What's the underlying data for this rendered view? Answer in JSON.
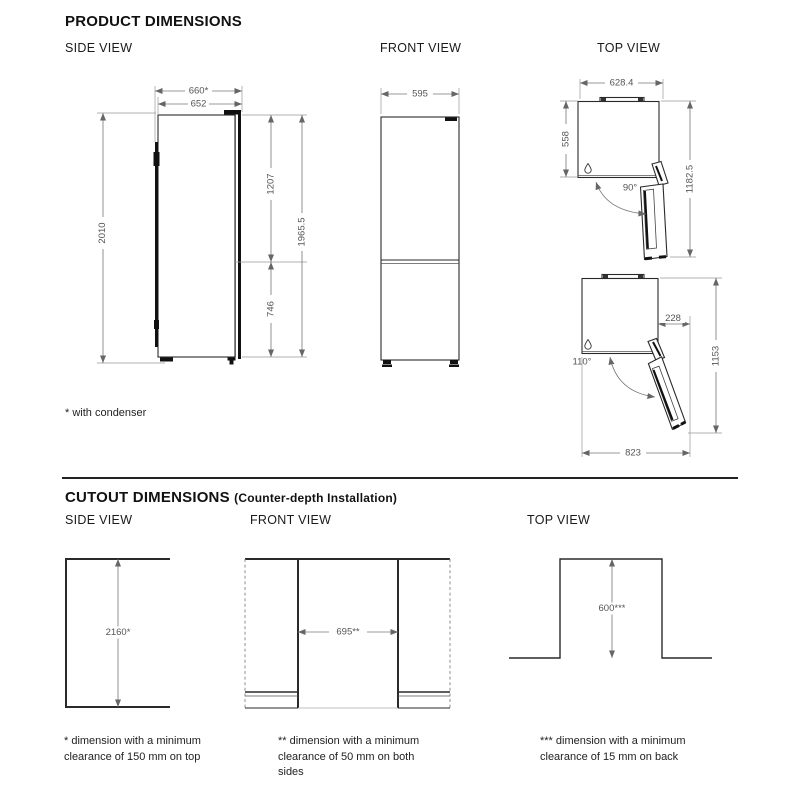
{
  "product": {
    "title": "PRODUCT DIMENSIONS",
    "side_view": {
      "label": "SIDE VIEW",
      "dims": {
        "depth_with_condenser": "660*",
        "depth": "652",
        "height_total": "2010",
        "door_upper": "1207",
        "door_lower": "746",
        "height_back": "1965.5"
      }
    },
    "front_view": {
      "label": "FRONT VIEW",
      "dims": {
        "width": "595"
      }
    },
    "top_view": {
      "label": "TOP VIEW",
      "door_90": {
        "width_overall": "628.4",
        "depth_body": "558",
        "depth_door_open": "1182.5",
        "angle": "90°"
      },
      "door_110": {
        "door_protrusion": "228",
        "depth_door_open": "1153",
        "width_door_open": "823",
        "angle": "110°"
      }
    },
    "footnote": "* with condenser"
  },
  "cutout": {
    "title": "CUTOUT DIMENSIONS",
    "subtitle": "(Counter-depth Installation)",
    "side_view": {
      "label": "SIDE VIEW",
      "dims": {
        "height": "2160*"
      }
    },
    "front_view": {
      "label": "FRONT VIEW",
      "dims": {
        "width": "695**"
      }
    },
    "top_view": {
      "label": "TOP VIEW",
      "dims": {
        "depth": "600***"
      }
    },
    "footnotes": [
      {
        "lines": [
          "* dimension with a minimum",
          "clearance of 150 mm on top"
        ]
      },
      {
        "lines": [
          "** dimension with a minimum",
          "clearance of 50 mm on both",
          "sides"
        ]
      },
      {
        "lines": [
          "*** dimension with a minimum",
          "clearance of 15 mm on back"
        ]
      }
    ]
  },
  "colors": {
    "object_line": "#2a2a2a",
    "dimension_line": "#777777",
    "text": "#1a1a1a",
    "background": "#ffffff"
  }
}
